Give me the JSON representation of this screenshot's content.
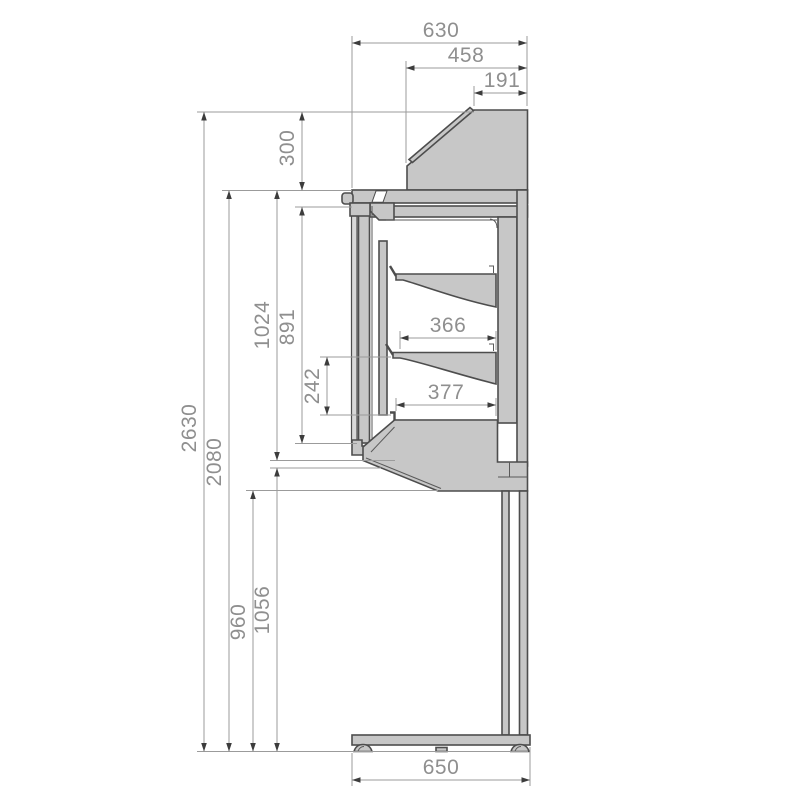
{
  "drawing": {
    "kind": "technical side-section drawing of a refrigerated display counter",
    "units": "mm"
  },
  "dimensions": {
    "top": {
      "d630": "630",
      "d458": "458",
      "d191": "191"
    },
    "left": {
      "d300": "300",
      "d2630": "2630",
      "d2080": "2080",
      "d1024": "1024",
      "d891": "891",
      "d242": "242",
      "d960": "960",
      "d1056": "1056"
    },
    "middle": {
      "d366": "366",
      "d377": "377"
    },
    "bottom": {
      "d650": "650"
    }
  },
  "colors": {
    "background": "#ffffff",
    "panel_fill": "#c7c7c7",
    "panel_fill_light": "#d8d8d8",
    "deck_fill": "#a9a9a9",
    "outline": "#4d4d4d",
    "dimension_line": "#9b9b9b",
    "dimension_text": "#8f8f8f",
    "arrowhead": "#3c3c3c"
  }
}
